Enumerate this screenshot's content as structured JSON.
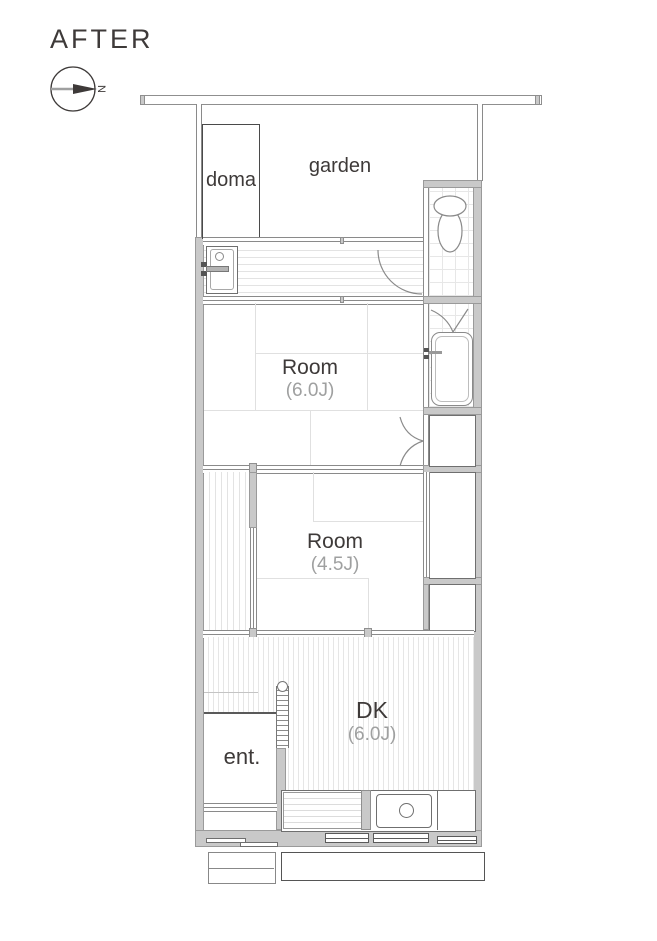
{
  "title": "AFTER",
  "compass": {
    "north_label": "N"
  },
  "colors": {
    "wall_fill": "#c9c9c9",
    "wall_edge": "#8f8f8f",
    "line_dark": "#595757",
    "text_dark": "#3e3a39",
    "text_light": "#9fa0a0"
  },
  "rooms": {
    "garden": {
      "label": "garden"
    },
    "doma": {
      "label": "doma"
    },
    "room_6j": {
      "name": "Room",
      "size": "(6.0J)"
    },
    "room_45j": {
      "name": "Room",
      "size": "(4.5J)"
    },
    "dk": {
      "name": "DK",
      "size": "(6.0J)"
    },
    "entrance": {
      "label": "ent."
    }
  }
}
